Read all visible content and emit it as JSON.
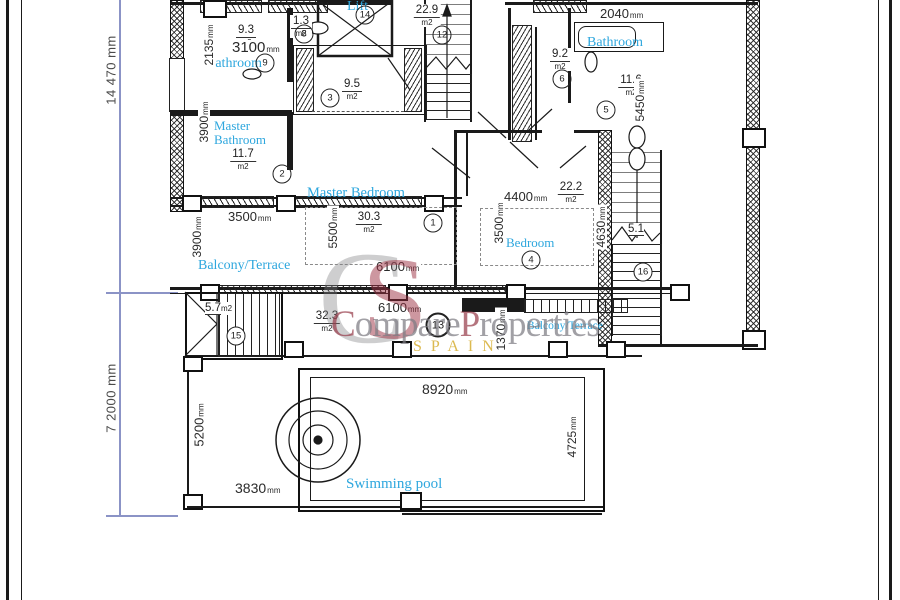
{
  "colors": {
    "label_blue": "#2ea7de",
    "line_black": "#1a1a1a",
    "dim_line": "#8b93c6",
    "watermark_gray": "#8b8b90",
    "watermark_red": "#9c2f42",
    "watermark_gold": "#d9b23e"
  },
  "overall": {
    "upper": "14 470 mm",
    "lower": "7 2000 mm"
  },
  "room_labels": {
    "lift": "Lift",
    "bathroom_top_left": "Bathroom",
    "master_bathroom_line1": "Master",
    "master_bathroom_line2": "Bathroom",
    "bathroom_top_right": "Bathroom",
    "master_bedroom": "Master Bedroom",
    "bedroom": "Bedroom",
    "balcony_left": "Balcony/Terrace",
    "balcony_mid": "Balcony/Terrace",
    "swimming_pool": "Swimming pool"
  },
  "areas": {
    "bathroom_tl": {
      "value": "9.3",
      "unit": "m2"
    },
    "wc": {
      "value": "1.3",
      "unit": "m2"
    },
    "dressing": {
      "value": "9.5",
      "unit": "m2"
    },
    "top_terrace": {
      "value": "22.9",
      "unit": "m2"
    },
    "bedroom_small": {
      "value": "9.2",
      "unit": "m2"
    },
    "bathroom_tr": {
      "value": "11.6",
      "unit": "m2"
    },
    "master_bathroom": {
      "value": "11.7",
      "unit": "m2"
    },
    "master_bedroom": {
      "value": "30.3",
      "unit": "m2"
    },
    "bedroom": {
      "value": "22.2",
      "unit": "m2"
    },
    "stairs_outdoor": {
      "value": "5.7",
      "unit": "m2"
    },
    "balcony": {
      "value": "32.3",
      "unit": "m2"
    },
    "stairs_right": {
      "value": "5.1",
      "unit": ""
    }
  },
  "linear_dims": {
    "d2135": {
      "value": "2135",
      "unit": "mm"
    },
    "d3100": {
      "value": "3100",
      "unit": "mm"
    },
    "d2040": {
      "value": "2040",
      "unit": "mm"
    },
    "d5450": {
      "value": "5450",
      "unit": "mm"
    },
    "d3900a": {
      "value": "3900",
      "unit": "mm"
    },
    "d3900b": {
      "value": "3900",
      "unit": "mm"
    },
    "d3500a": {
      "value": "3500",
      "unit": "mm"
    },
    "d5500": {
      "value": "5500",
      "unit": "mm"
    },
    "d6100a": {
      "value": "6100",
      "unit": "mm"
    },
    "d6100b": {
      "value": "6100",
      "unit": "mm"
    },
    "d4400": {
      "value": "4400",
      "unit": "mm"
    },
    "d3500b": {
      "value": "3500",
      "unit": "mm"
    },
    "d4630": {
      "value": "4630",
      "unit": "mm"
    },
    "d1370": {
      "value": "1370",
      "unit": "mm"
    },
    "d8920": {
      "value": "8920",
      "unit": "mm"
    },
    "d5200": {
      "value": "5200",
      "unit": "mm"
    },
    "d4725": {
      "value": "4725",
      "unit": "mm"
    },
    "d3830": {
      "value": "3830",
      "unit": "mm"
    }
  },
  "circles": {
    "c1": "1",
    "c2": "2",
    "c3": "3",
    "c4": "4",
    "c5": "5",
    "c6": "6",
    "c8": "8",
    "c9": "9",
    "c12": "12",
    "c13": "13",
    "c14": "14",
    "c15": "15",
    "c16": "16"
  },
  "watermark": {
    "monogram_c": "C",
    "monogram_s": "S",
    "name_c": "C",
    "name_rest1": "ompare",
    "name_p": "P",
    "name_rest2": "roperties",
    "country": "SPAIN"
  }
}
